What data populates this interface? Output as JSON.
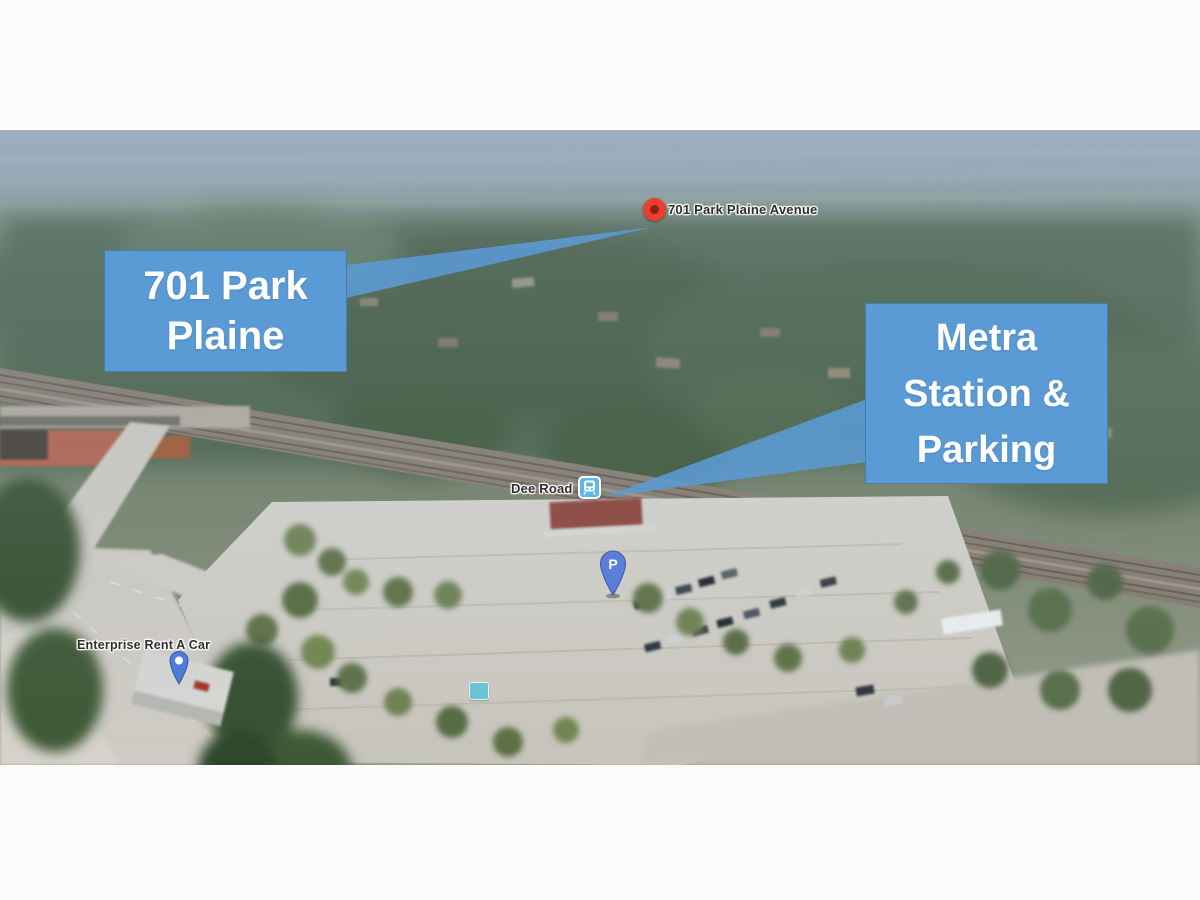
{
  "page": {
    "background": "#fbfbfc"
  },
  "callouts": {
    "fill_color": "#5B9BD5",
    "text_color": "#FFFFFF",
    "left": {
      "lines": [
        "701 Park",
        "Plaine"
      ]
    },
    "right": {
      "lines": [
        "Metra",
        "Station &",
        "Parking"
      ]
    }
  },
  "markers": {
    "address_pin": {
      "label": "701 Park Plaine Avenue",
      "color": "#E8402D"
    },
    "metra_station": {
      "label": "Dee Road",
      "icon_color": "#5CB8E8"
    },
    "parking_pin": {
      "glyph": "P",
      "color": "#5D7ED8"
    },
    "enterprise": {
      "label": "Enterprise Rent A Car",
      "pin_color": "#4C7ED9"
    },
    "transit_stop": {
      "icon_color": "#62C3D8"
    }
  }
}
